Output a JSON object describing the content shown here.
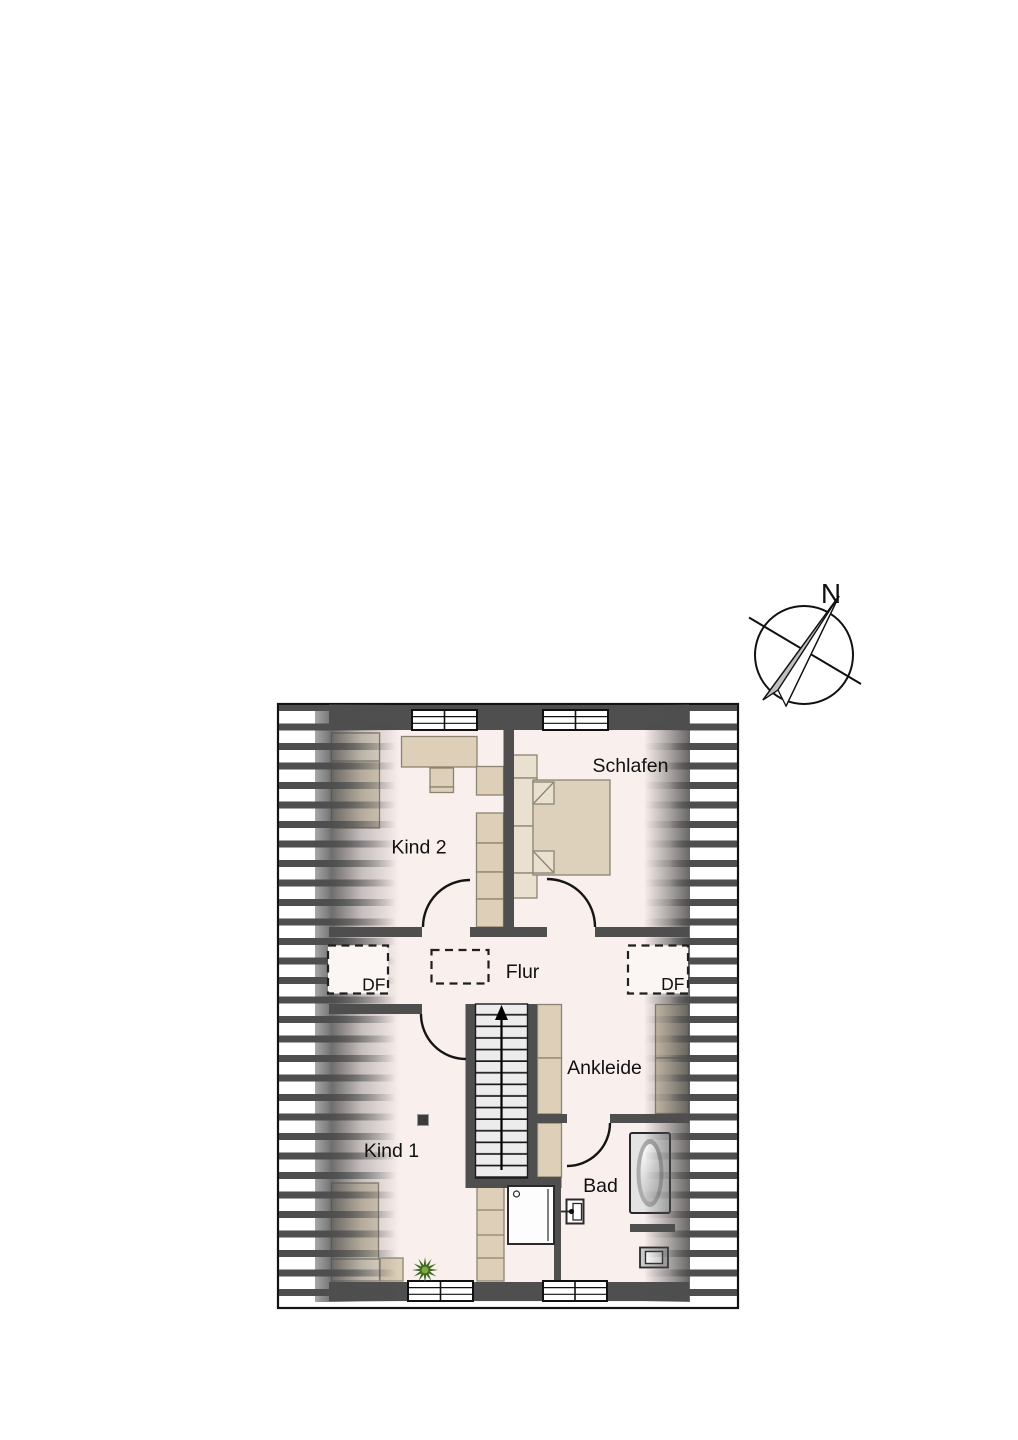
{
  "compass": {
    "north_label": "N"
  },
  "floorplan": {
    "rooms": [
      {
        "id": "schlafen",
        "label": "Schlafen"
      },
      {
        "id": "kind2",
        "label": "Kind 2"
      },
      {
        "id": "flur",
        "label": "Flur"
      },
      {
        "id": "ankleide",
        "label": "Ankleide"
      },
      {
        "id": "kind1",
        "label": "Kind 1"
      },
      {
        "id": "bad",
        "label": "Bad"
      }
    ],
    "roof_window_labels": [
      "DF",
      "DF"
    ],
    "colors": {
      "wall": "#4f4f4f",
      "floor": "#f9efed",
      "furniture": "#ddcfb8",
      "furniture_light": "#eae0d0",
      "bed": "#e1d4bf",
      "hatch": "#4e4e4e",
      "stair_tread": "#ececec",
      "plant_dark": "#3e6b22",
      "plant_light": "#85a93e",
      "outline": "#141414"
    }
  }
}
